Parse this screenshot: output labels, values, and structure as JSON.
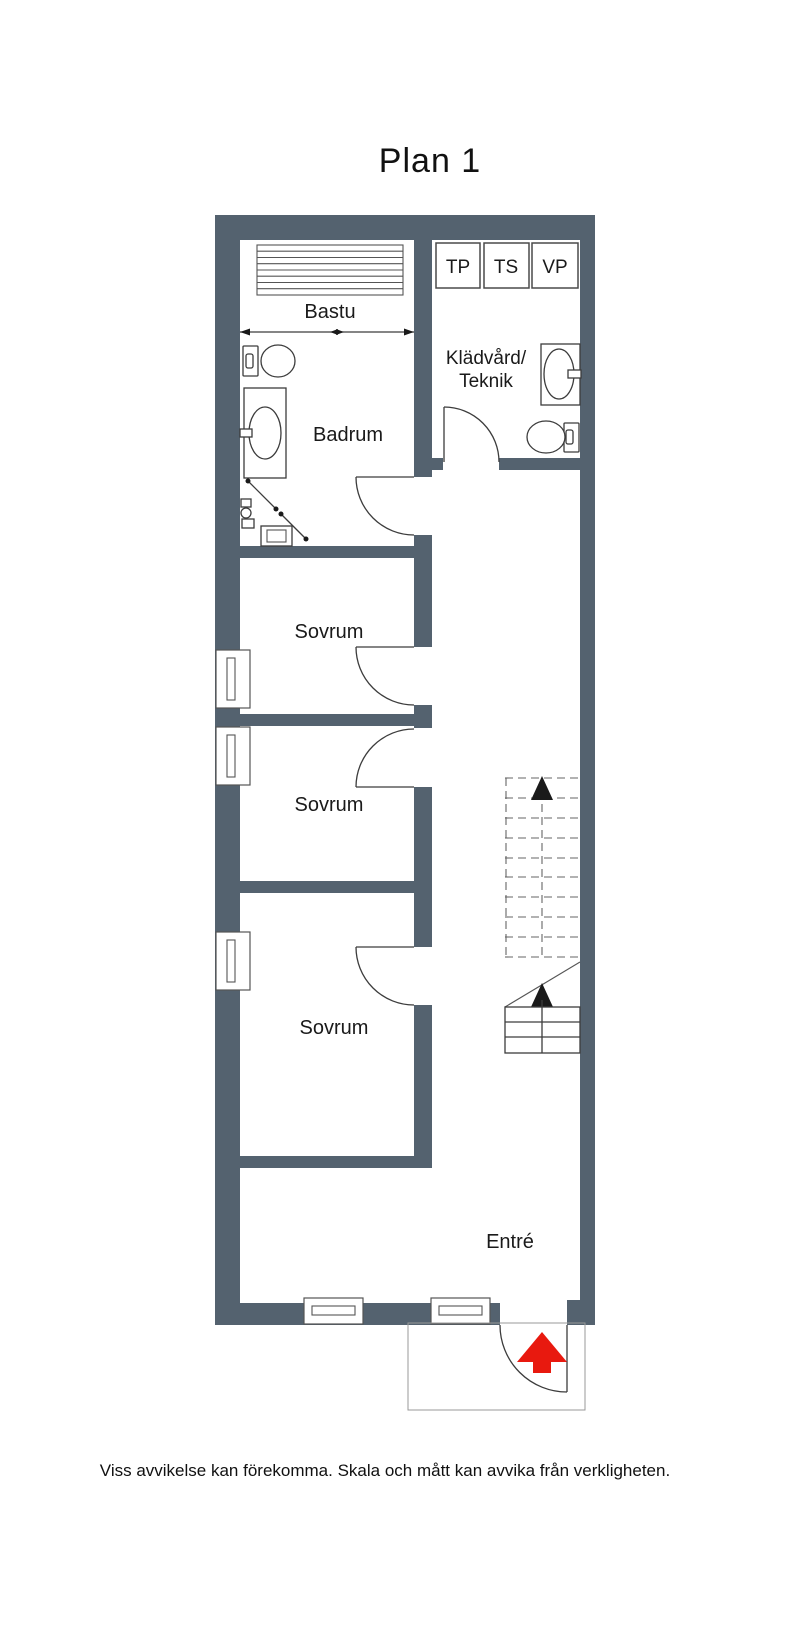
{
  "title": "Plan 1",
  "plan": {
    "rooms": {
      "bastu": "Bastu",
      "badrum": "Badrum",
      "kladvard_line1": "Klädvård/",
      "kladvard_line2": "Teknik",
      "sovrum_1": "Sovrum",
      "sovrum_2": "Sovrum",
      "sovrum_3": "Sovrum",
      "entre": "Entré"
    },
    "closets": {
      "tp": "TP",
      "ts": "TS",
      "vp": "VP"
    },
    "colors": {
      "wall": "#54626f",
      "entry_arrow": "#e8190f",
      "line": "#3c3c3c",
      "stair_arrow": "#111111"
    }
  },
  "footer": {
    "disclaimer": "Viss avvikelse kan förekomma. Skala och mått kan avvika från verkligheten."
  }
}
